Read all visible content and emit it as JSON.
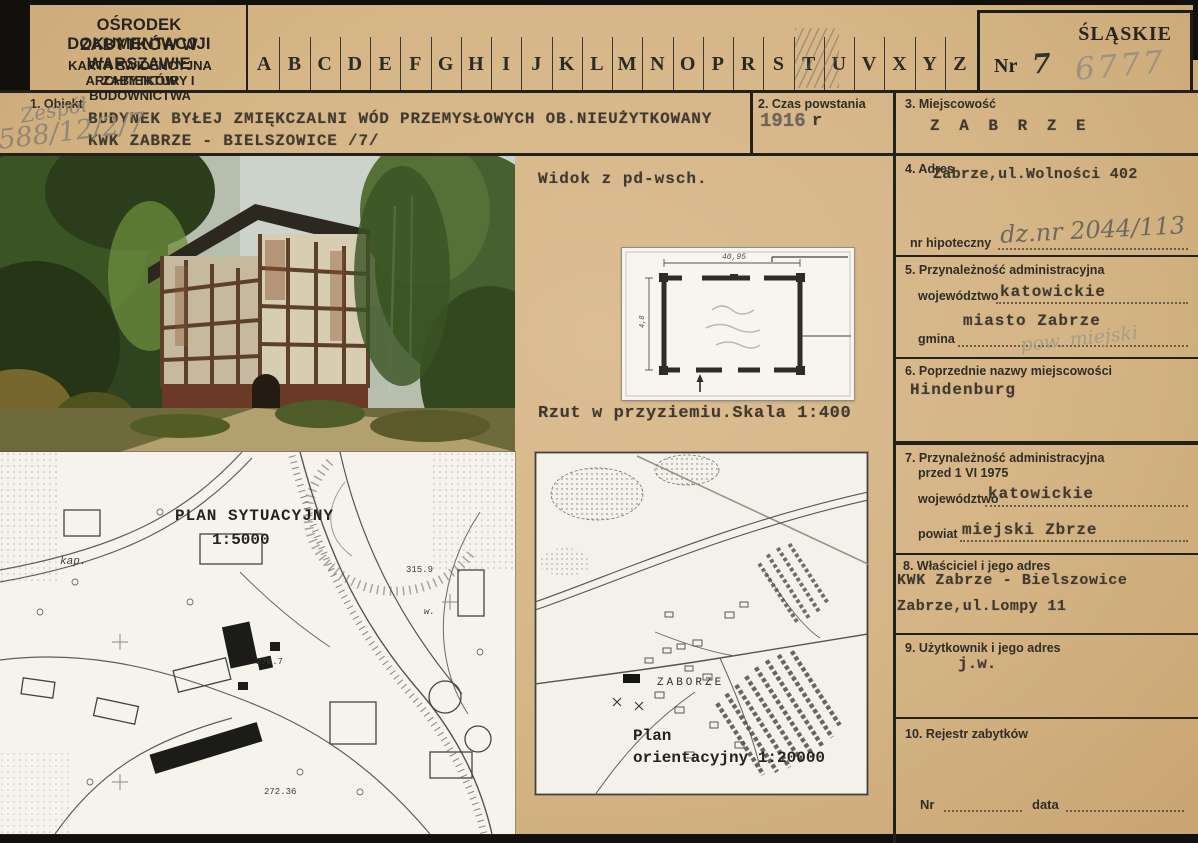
{
  "palette": {
    "card": "#d7b78a",
    "ink": "#2b2924",
    "typed": "#3f3a31",
    "pencil": "#8f8778",
    "map_paper": "#f4f2ea"
  },
  "header": {
    "org_line1": "OŚRODEK DOKUMENTACJJI",
    "org_line2": "ZABYTKÓW W WARSZAWIE",
    "card_line1": "KARTA EWIDENCYJNA ZABYTKÓW",
    "card_line2": "ARCHITEKTURY I BUDOWNICTWA",
    "letters": [
      "A",
      "B",
      "C",
      "D",
      "E",
      "F",
      "G",
      "H",
      "I",
      "J",
      "K",
      "L",
      "M",
      "N",
      "O",
      "P",
      "R",
      "S",
      "T",
      "U",
      "V",
      "X",
      "Y",
      "Z"
    ],
    "region": "ŚLĄSKIE",
    "nr_label": "Nr",
    "nr_value": "7",
    "pencil_number": "6777"
  },
  "s1": {
    "label": "1.  Obiekt",
    "line1": "BUDYNEK BYŁEJ ZMIĘKCZALNI WÓD PRZEMYSŁOWYCH OB.NIEUŻYTKOWANY",
    "line2": "KWK ZABRZE - BIELSZOWICE /7/",
    "pencil_word": "Zespół",
    "pencil_number": "588/12/2/7"
  },
  "s2": {
    "label": "2.  Czas powstania",
    "year": "1916",
    "suffix": "r"
  },
  "s3": {
    "label": "3.  Miejscowość",
    "value": "Z A B R Z E"
  },
  "s4": {
    "label": "4.  Adres",
    "value": "Zabrze,ul.Wolności 402",
    "hipoteczny_label": "nr hipoteczny",
    "hipoteczny_value": "dz.nr 2044/113"
  },
  "s5": {
    "label": "5.  Przynależność administracyjna",
    "wojewodztwo_label": "województwo",
    "wojewodztwo_value": "katowickie",
    "gmina_label": "gmina",
    "gmina_value": "miasto Zabrze",
    "gmina_pencil": "pow. miejski"
  },
  "s6": {
    "label": "6.  Poprzednie nazwy miejscowości",
    "value": "Hindenburg"
  },
  "s7": {
    "label": "7.  Przynależność administracyjna",
    "label2": "przed 1 VI 1975",
    "wojewodztwo_label": "województwo",
    "wojewodztwo_value": "katowickie",
    "powiat_label": "powiat",
    "powiat_value": "miejski Zbrze"
  },
  "s8": {
    "label": "8.  Właściciel i jego adres",
    "line1": "KWK Zabrze - Bielszowice",
    "line2": "Zabrze,ul.Lompy 11"
  },
  "s9": {
    "label": "9.  Użytkownik i jego adres",
    "value": "j.w."
  },
  "s10": {
    "label": "10.  Rejestr zabytków",
    "nr_label": "Nr",
    "data_label": "data"
  },
  "middle": {
    "photo_caption": "Widok z pd-wsch.",
    "plan_caption": "Rzut w przyziemiu.Skala 1:400",
    "plan_dim_top": "40,95",
    "plan_dim_left": "4,8"
  },
  "maps": {
    "situational_title_line1": "PLAN SYTUACYJNY",
    "situational_title_line2": "1:5000",
    "label_kap": "kap.",
    "label_h1": "315.9",
    "label_h2": "270.7",
    "label_h3": "272.36",
    "label_w": "w.",
    "orientation_line1": "Plan",
    "orientation_line2": "orientacyjny 1:20000",
    "label_zaborze": "ZABORZE"
  }
}
